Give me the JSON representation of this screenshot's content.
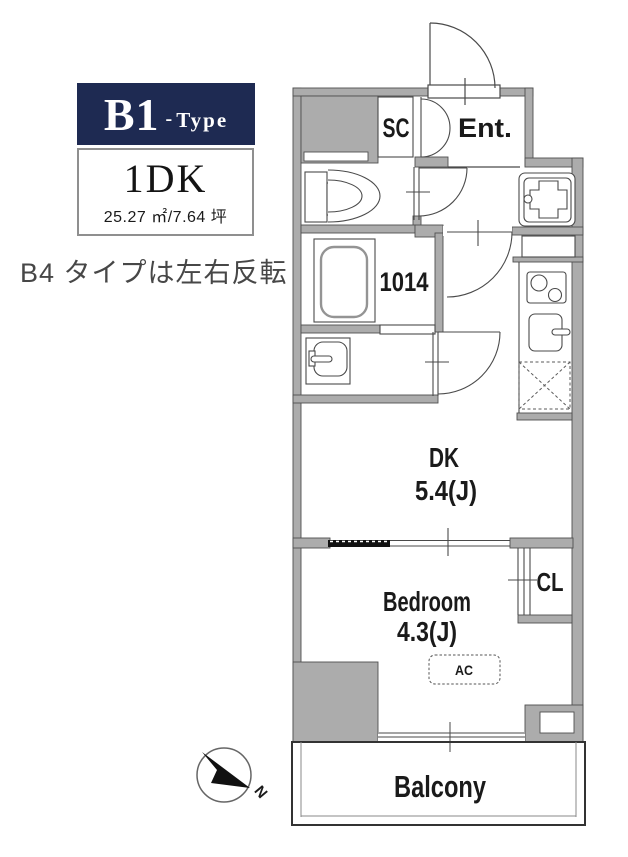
{
  "header": {
    "type_badge": {
      "primary": "B1",
      "dash": "-",
      "suffix": "Type"
    },
    "layout_box": {
      "layout": "1DK",
      "area": "25.27 ㎡/7.64 坪"
    },
    "note": "B4 タイプは左右反転"
  },
  "plan": {
    "labels": {
      "shoe_closet": "SC",
      "entrance": "Ent.",
      "bath_unit": "1014",
      "dining_kitchen": "DK",
      "dining_kitchen_size": "5.4(J)",
      "bedroom": "Bedroom",
      "bedroom_size": "4.3(J)",
      "closet": "CL",
      "air_conditioner": "AC",
      "balcony": "Balcony"
    },
    "colors": {
      "wall_gray": "#acacac",
      "outline": "#4a4a4a",
      "badge_navy": "#1e2a52",
      "text": "#1a1a1a"
    }
  },
  "compass": {
    "north": "N"
  }
}
